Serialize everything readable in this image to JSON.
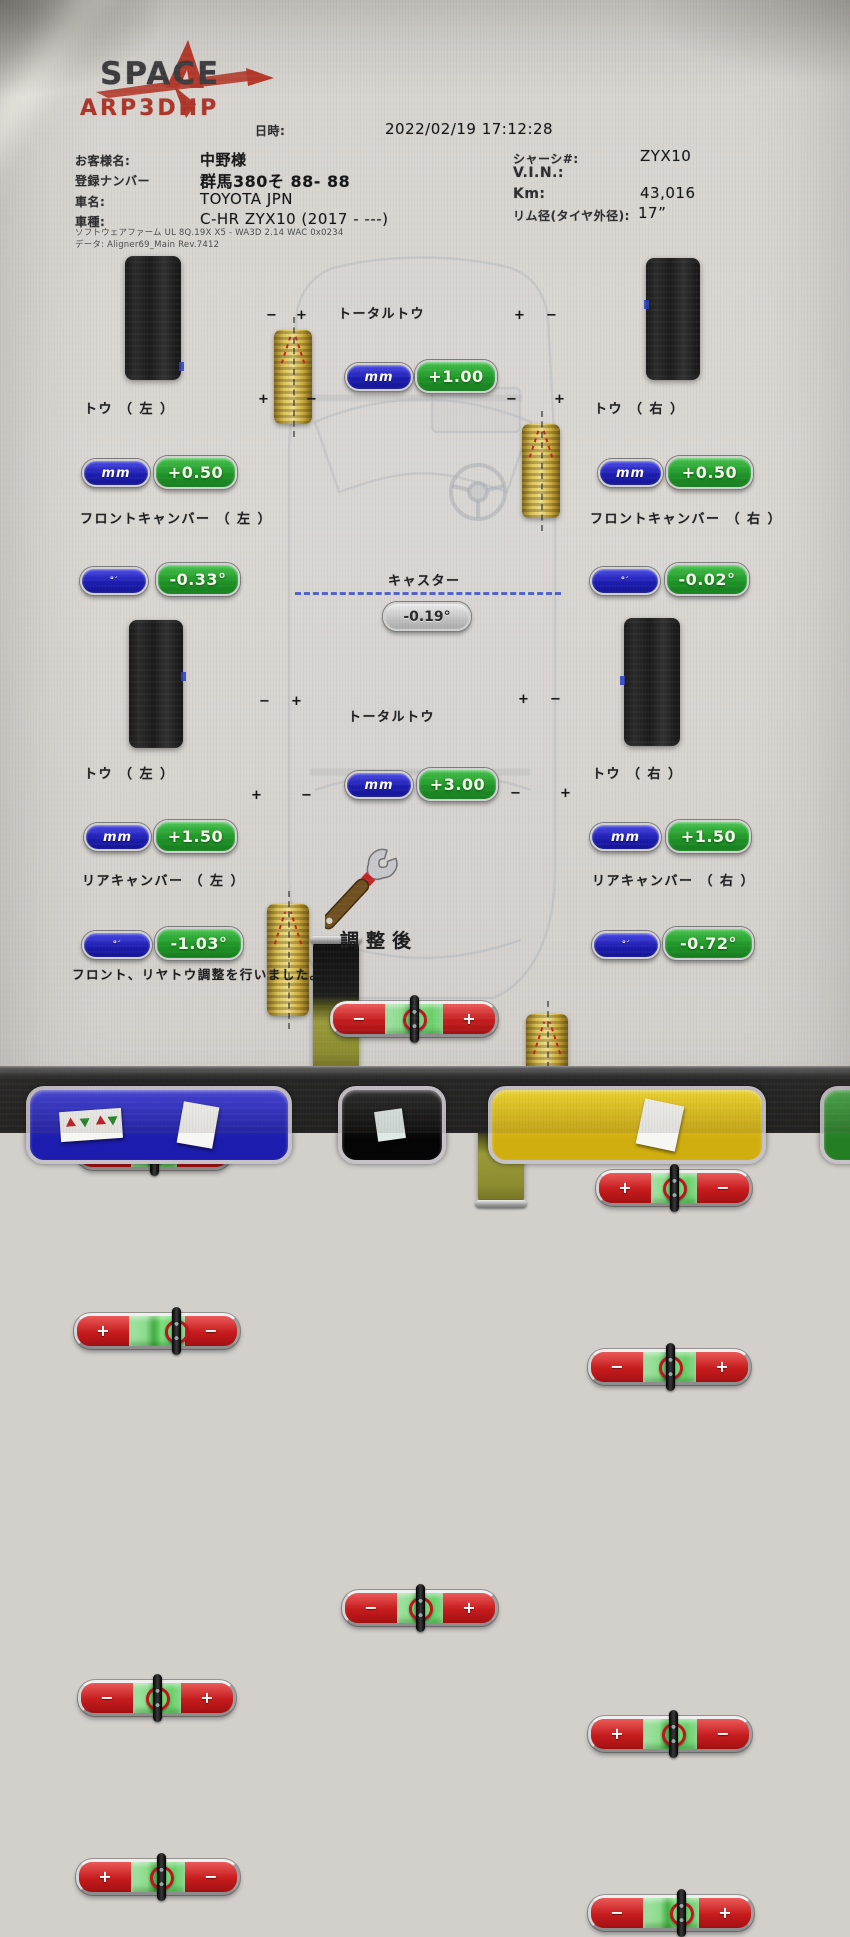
{
  "logo": {
    "brand": "SPACE",
    "model": "ARP3DHP"
  },
  "header": {
    "datetime_label": "日時:",
    "datetime": "2022/02/19 17:12:28"
  },
  "customer_info": {
    "name_label": "お客様名:",
    "name": "中野様",
    "plate_label": "登録ナンバー",
    "plate": "群馬380そ 88- 88",
    "make_label": "車名:",
    "make": "TOYOTA JPN",
    "model_label": "車種:",
    "model": "C-HR ZYX10 (2017 - ---)"
  },
  "vehicle_info": {
    "chassis_label": "シャーシ#:",
    "chassis": "ZYX10",
    "vin_label": "V.I.N.:",
    "vin": "",
    "km_label": "Km:",
    "km": "43,016",
    "rim_label": "リム径(タイヤ外径):",
    "rim": "17”"
  },
  "software": {
    "line1": "ソフトウェアファーム UL 8Q.19X X5 - WA3D 2.14 WAC 0x0234",
    "line2": "データ: Aligner69_Main Rev.7412"
  },
  "front": {
    "total_toe": {
      "label": "トータルトウ",
      "unit": "mm",
      "value": "+1.00",
      "left_sign": "−",
      "right_sign": "+",
      "indicator": "50%"
    },
    "toe_left": {
      "label": "トウ （ 左 ）",
      "unit": "mm",
      "value": "+0.50",
      "left_sign": "−",
      "right_sign": "+",
      "indicator": "50%"
    },
    "toe_right": {
      "label": "トウ （ 右 ）",
      "unit": "mm",
      "value": "+0.50",
      "left_sign": "+",
      "right_sign": "−",
      "indicator": "50%"
    },
    "camber_left": {
      "label": "フロントキャンバー （ 左 ）",
      "unit": "°′",
      "value": "-0.33°",
      "left_sign": "+",
      "right_sign": "−",
      "indicator": "62%"
    },
    "camber_right": {
      "label": "フロントキャンバー （ 右 ）",
      "unit": "°′",
      "value": "-0.02°",
      "left_sign": "−",
      "right_sign": "+",
      "indicator": "50%"
    },
    "caster": {
      "label": "キャスター",
      "value": "-0.19°"
    }
  },
  "rear": {
    "total_toe": {
      "label": "トータルトウ",
      "unit": "mm",
      "value": "+3.00",
      "left_sign": "−",
      "right_sign": "+",
      "indicator": "50%"
    },
    "toe_left": {
      "label": "トウ （ 左 ）",
      "unit": "mm",
      "value": "+1.50",
      "left_sign": "−",
      "right_sign": "+",
      "indicator": "50%"
    },
    "toe_right": {
      "label": "トウ （ 右 ）",
      "unit": "mm",
      "value": "+1.50",
      "left_sign": "+",
      "right_sign": "−",
      "indicator": "52%"
    },
    "camber_left": {
      "label": "リアキャンバー （ 左 ）",
      "unit": "°′",
      "value": "-1.03°",
      "left_sign": "+",
      "right_sign": "−",
      "indicator": "52%"
    },
    "camber_right": {
      "label": "リアキャンバー （ 右 ）",
      "unit": "°′",
      "value": "-0.72°",
      "left_sign": "−",
      "right_sign": "+",
      "indicator": "56%"
    }
  },
  "tire_marks": {
    "front_left": {
      "tl": "−",
      "tr": "+",
      "bl": "+",
      "br": "−"
    },
    "front_right": {
      "tl": "+",
      "tr": "−",
      "bl": "−",
      "br": "+"
    },
    "rear_left": {
      "tl": "−",
      "tr": "+",
      "bl": "+",
      "br": "−"
    },
    "rear_right": {
      "tl": "+",
      "tr": "−",
      "bl": "−",
      "br": "+"
    }
  },
  "footer": {
    "status": "調整後",
    "note": "フロント、リヤトウ調整を行いました。"
  },
  "colors": {
    "accent_red": "#c61c1e",
    "accent_green": "#1e9627",
    "accent_blue": "#1c1cb2",
    "tire_gold": "#d9c054"
  }
}
